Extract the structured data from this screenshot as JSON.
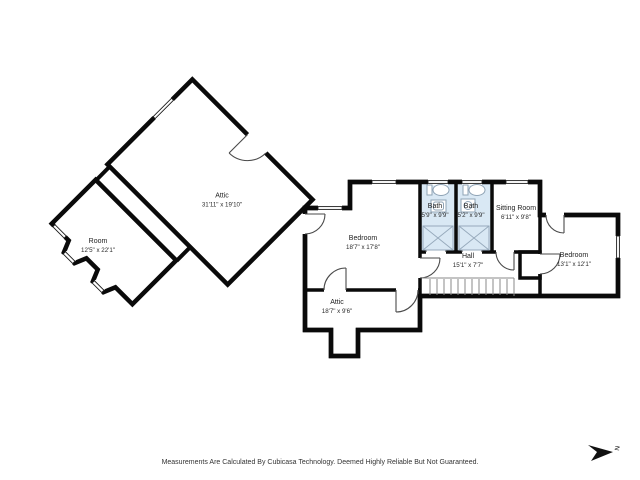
{
  "plan": {
    "rooms": [
      {
        "name": "Attic",
        "dims": "31'11\" x 19'10\""
      },
      {
        "name": "Room",
        "dims": "12'5\" x 22'1\""
      },
      {
        "name": "Bedroom",
        "dims": "18'7\" x 17'8\""
      },
      {
        "name": "Bath",
        "dims": "5'9\" x 9'9\""
      },
      {
        "name": "Bath",
        "dims": "5'2\" x 9'9\""
      },
      {
        "name": "Sitting Room",
        "dims": "6'11\" x 9'8\""
      },
      {
        "name": "Hall",
        "dims": "15'1\" x 7'7\""
      },
      {
        "name": "Bedroom",
        "dims": "13'1\" x 12'1\""
      },
      {
        "name": "Attic",
        "dims": "18'7\" x 9'6\""
      }
    ],
    "compass": {
      "label": "N"
    },
    "footer": {
      "disclaimer": "Measurements Are Calculated By Cubicasa Technology. Deemed Highly Reliable But Not Guaranteed."
    },
    "colors": {
      "wall": "#0a0a0a",
      "bath_fill": "#d9e8f4",
      "fixture": "#8fa3b5",
      "stairs": "#8a8a8a"
    }
  }
}
